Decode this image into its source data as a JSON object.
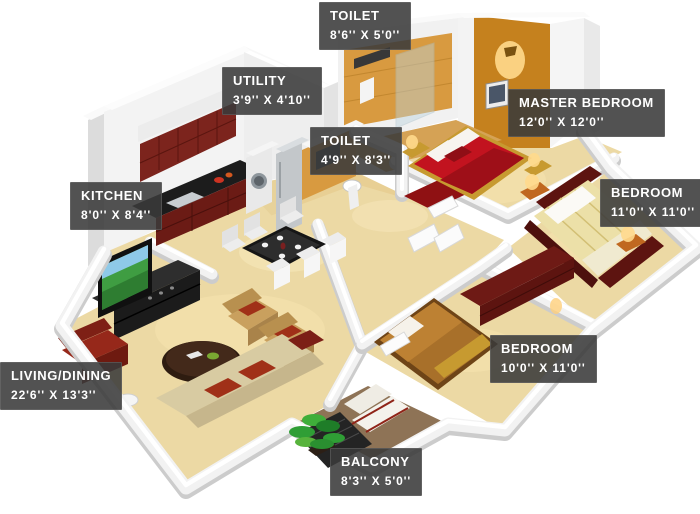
{
  "labels": [
    {
      "id": "toilet-top",
      "name": "TOILET",
      "dims": "8'6'' X 5'0''"
    },
    {
      "id": "utility",
      "name": "UTILITY",
      "dims": "3'9'' X 4'10''"
    },
    {
      "id": "master-bedroom",
      "name": "MASTER BEDROOM",
      "dims": "12'0'' X 12'0''"
    },
    {
      "id": "toilet-mid",
      "name": "TOILET",
      "dims": "4'9'' X 8'3''"
    },
    {
      "id": "kitchen",
      "name": "KITCHEN",
      "dims": "8'0'' X 8'4''"
    },
    {
      "id": "bedroom-right",
      "name": "BEDROOM",
      "dims": "11'0'' X 11'0''"
    },
    {
      "id": "bedroom-bottom",
      "name": "BEDROOM",
      "dims": "10'0'' X 11'0''"
    },
    {
      "id": "living-dining",
      "name": "LIVING/DINING",
      "dims": "22'6'' X 13'3''"
    },
    {
      "id": "balcony",
      "name": "BALCONY",
      "dims": "8'3'' X 5'0''"
    }
  ],
  "colors": {
    "label_bg": "rgba(58,58,58,0.88)",
    "label_text": "#ffffff",
    "wall": "#f2f2f2",
    "floor": "#ecd9a4",
    "tile_orange": "#d89a40",
    "accent_wall": "#c5811e",
    "cabinet": "#7c241d",
    "bed_red": "#c2131f",
    "bed_maroon": "#5d1410",
    "balcony_floor": "#8e7356",
    "sofa": "#d8cba2",
    "armchair": "#c9a05e",
    "cushion": "#a03018",
    "tv_screen": "#3f9d42",
    "plant": "#2f9e35",
    "glow": "#ffd98c"
  }
}
